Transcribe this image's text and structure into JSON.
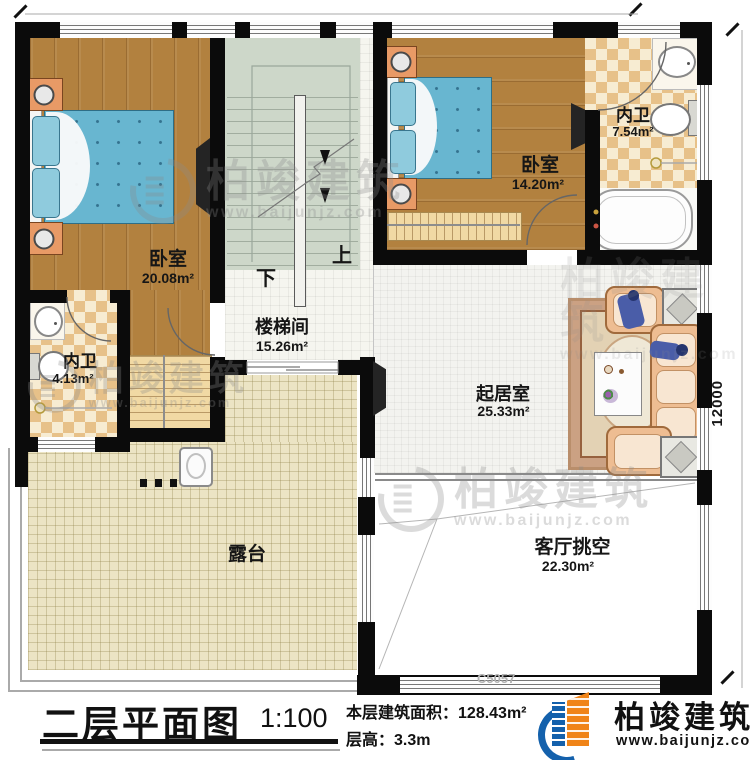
{
  "plan": {
    "rooms": [
      {
        "name": "卧室",
        "area": "20.08m²"
      },
      {
        "name": "内卫",
        "area": "4.13m²"
      },
      {
        "name": "楼梯间",
        "area": "15.26m²"
      },
      {
        "name": "卧室",
        "area": "14.20m²"
      },
      {
        "name": "内卫",
        "area": "7.54m²"
      },
      {
        "name": "起居室",
        "area": "25.33m²"
      },
      {
        "name": "客厅挑空",
        "area": "22.30m²"
      },
      {
        "name": "露台",
        "area": ""
      }
    ],
    "stairs": {
      "up": "上",
      "down": "下"
    },
    "dimension_right": "12000"
  },
  "titleblock": {
    "title": "二层平面图",
    "scale": "1:100",
    "area_label": "本层建筑面积：",
    "area_value": "128.43m²",
    "height_label": "层高：",
    "height_value": "3.3m",
    "drawing_code": "C5057"
  },
  "brand": {
    "name": "柏竣建筑",
    "url": "www.baijunjz.com"
  },
  "watermark": {
    "name": "柏竣建筑",
    "url": "www.baijunjz.com"
  },
  "colors": {
    "wall": "#0b0b0b",
    "wood": "#b2813f",
    "bath_tile": "#e7c189",
    "stair": "#cdd7c9",
    "terrace": "#ece4c4",
    "bed": "#68b6d0",
    "logo_blue": "#1461ac",
    "logo_orange": "#f08418"
  }
}
